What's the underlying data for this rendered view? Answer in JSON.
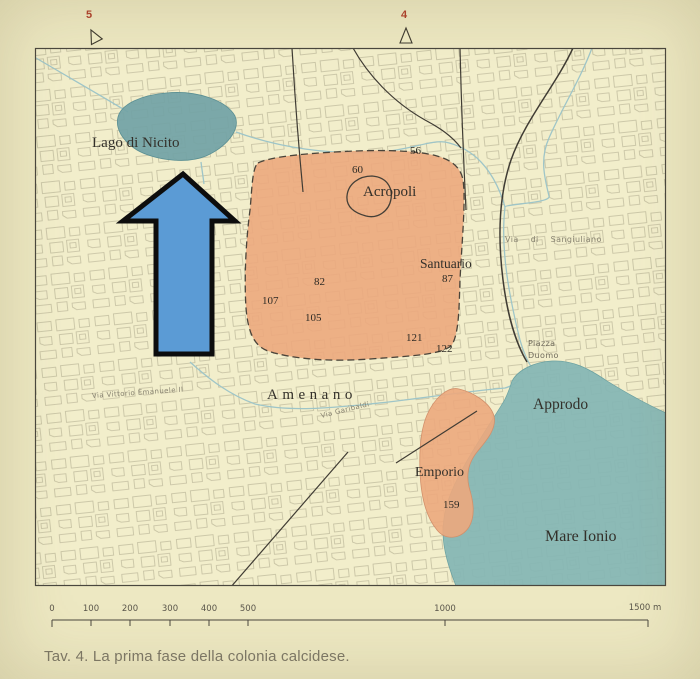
{
  "figure": {
    "caption": "Tav. 4. La prima fase della colonia calcidese."
  },
  "plate_markers": {
    "left_number": "5",
    "right_number": "4"
  },
  "map": {
    "water_labels": {
      "lago": "Lago di Nicito",
      "mare": "Mare Ionio",
      "fiume": "Amenano"
    },
    "area_labels": {
      "acropoli": "Acropoli",
      "santuario": "Santuario",
      "approdo": "Approdo",
      "emporio": "Emporio"
    },
    "street_labels": {
      "via_vittorio": "Via Vittorio Emanuele II",
      "via_garibaldi": "Via Garibaldi",
      "via_sangiuliano": "Via di Sangiuliano",
      "piazza_line1": "Piazza",
      "piazza_line2": "Duomo"
    },
    "site_numbers": [
      "56",
      "60",
      "87",
      "82",
      "107",
      "105",
      "121",
      "122",
      "159"
    ]
  },
  "scalebar": {
    "tick_labels": [
      "0",
      "100",
      "200",
      "300",
      "400",
      "500",
      "1000"
    ],
    "end_label": "1500 m"
  },
  "colors": {
    "page_bg": "#ede8c2",
    "map_bg": "#f2eecb",
    "settlement_fill": "#eca87d",
    "lake_fill": "#72a3a6",
    "sea_fill": "#86b6b4",
    "arrow_fill": "#5b9bd5",
    "arrow_outline": "#0d0d0d",
    "plate_marker_red": "#b0402c"
  }
}
